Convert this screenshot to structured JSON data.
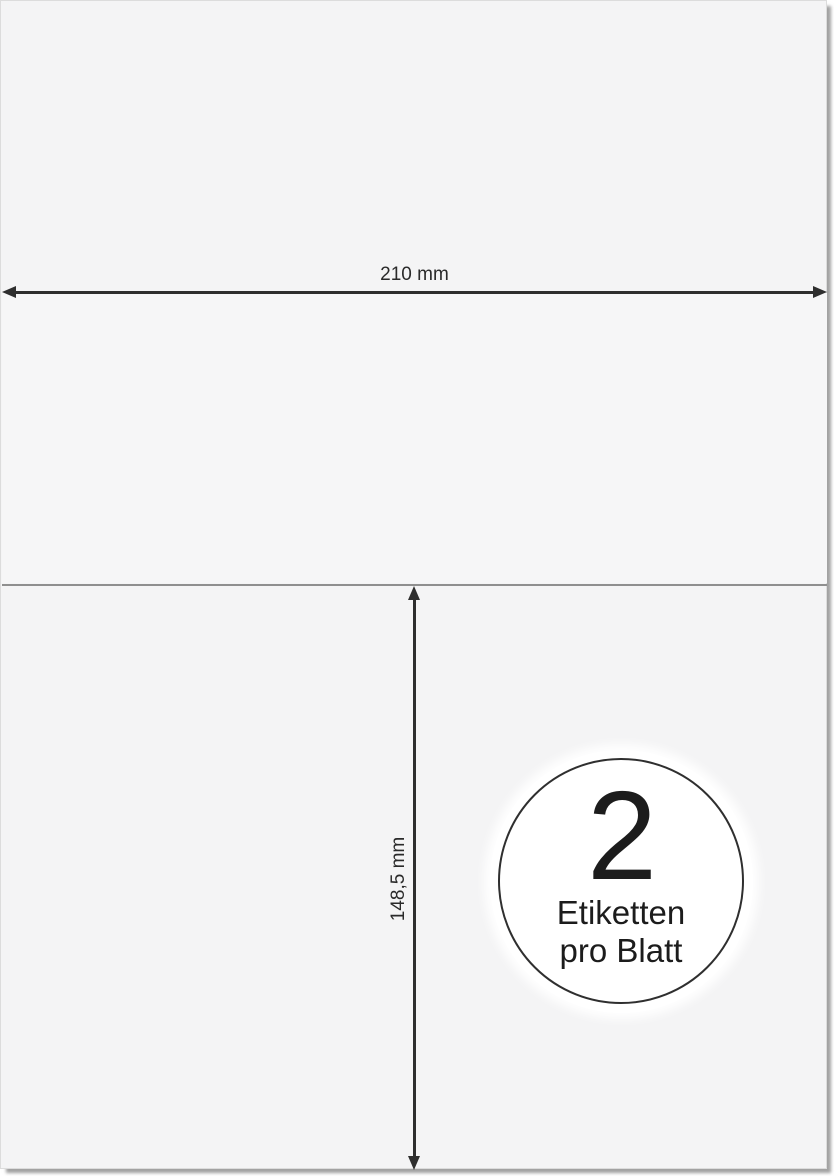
{
  "sheet": {
    "description": "A4 label sheet schematic",
    "background_color": "#f4f4f5",
    "shadow_color": "#6e6e6e",
    "divider_color": "#8f8f8f",
    "dimension_line_color": "#2e2e2e"
  },
  "dimensions": {
    "width_label": "210 mm",
    "height_label": "148,5 mm"
  },
  "badge": {
    "count": "2",
    "caption_line1": "Etiketten",
    "caption_line2": "pro Blatt",
    "border_color": "#2f2f2f",
    "fill_color": "#ffffff"
  }
}
